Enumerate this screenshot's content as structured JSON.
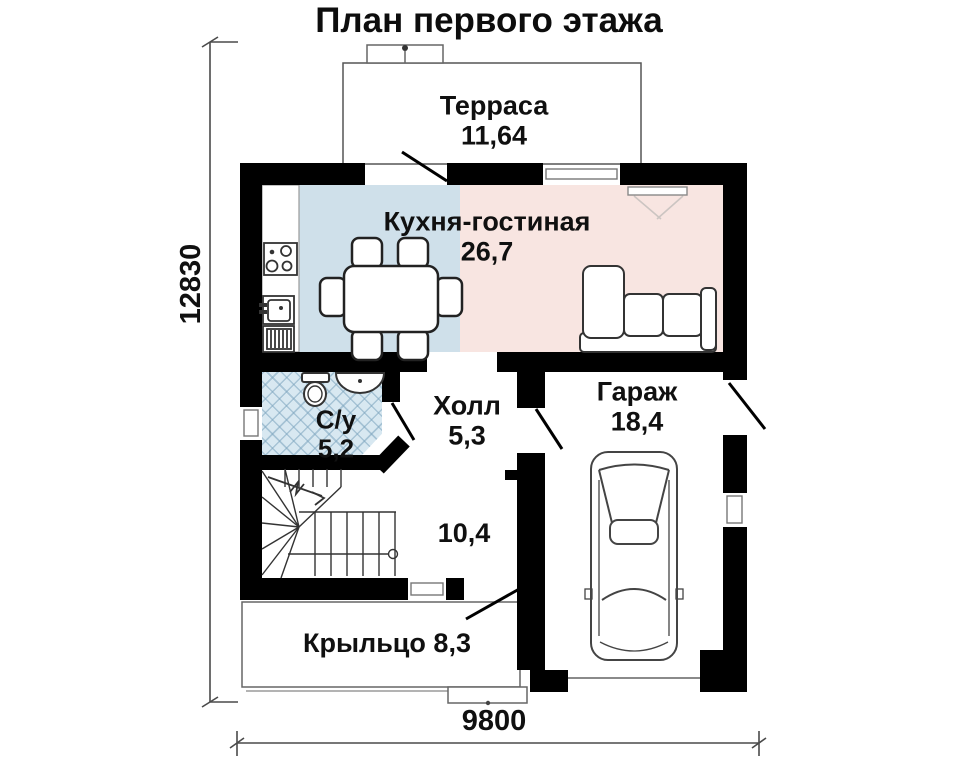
{
  "title": "План первого этажа",
  "rooms": {
    "terrace": {
      "name": "Терраса",
      "area": "11,64"
    },
    "kitchen_living": {
      "name": "Кухня-гостиная",
      "area": "26,7"
    },
    "bathroom": {
      "name": "С/у",
      "area": "5,2"
    },
    "hall": {
      "name": "Холл",
      "area": "5,3"
    },
    "garage": {
      "name": "Гараж",
      "area": "18,4"
    },
    "stair_hall": {
      "area": "10,4"
    },
    "porch": {
      "name": "Крыльцо",
      "area": "8,3"
    }
  },
  "dimensions": {
    "vertical_mm": "12830",
    "horizontal_mm": "9800"
  },
  "colors": {
    "wall": "#000000",
    "kitchen_fill": "#cfe0ea",
    "living_fill": "#f8e5e1",
    "bathroom_fill": "#d8e8f1",
    "outline_gray": "#666666"
  },
  "furniture_icons": [
    "dining-table-icon",
    "chair-icon",
    "stove-icon",
    "kitchen-sink-icon",
    "washer-icon",
    "corner-sofa-icon",
    "tv-panel-icon",
    "toilet-icon",
    "washbasin-icon",
    "winder-stairs-icon",
    "car-icon",
    "door-swing-icon",
    "window-icon"
  ]
}
